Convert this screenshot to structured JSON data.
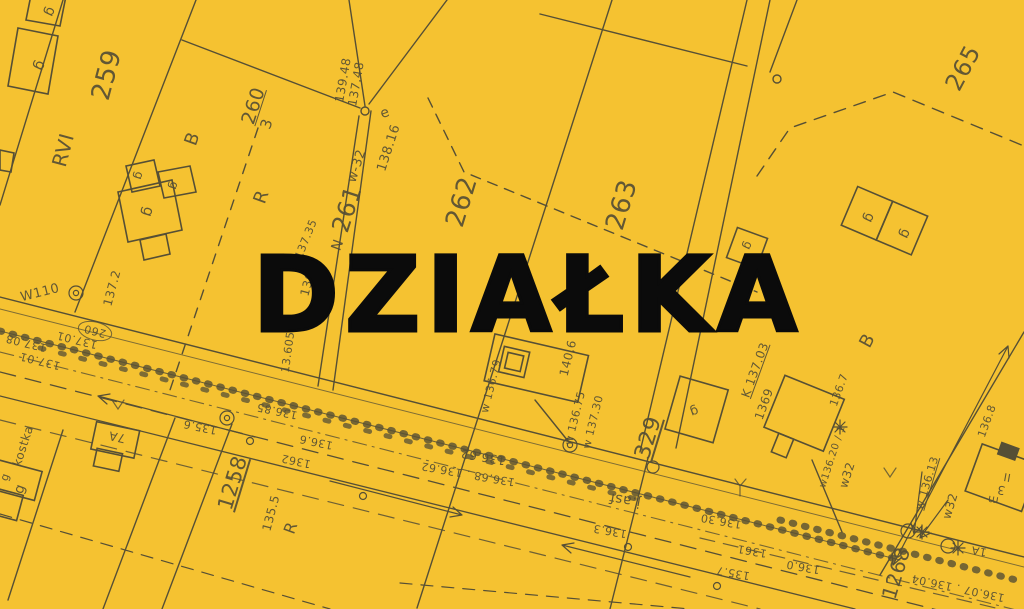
{
  "title": "DZIAŁKA",
  "colors": {
    "background": "#F5C231",
    "line": "#564F35",
    "title": "#0B0B0B"
  },
  "map": {
    "type": "cadastral-plan",
    "labels": [
      {
        "t": "259",
        "x": 107,
        "y": 75,
        "r": -75,
        "s": 26
      },
      {
        "t": "RVI",
        "x": 63,
        "y": 150,
        "r": -75,
        "s": 20
      },
      {
        "t": "260",
        "x": 254,
        "y": 106,
        "r": -72,
        "s": 19,
        "u": 1
      },
      {
        "t": "3",
        "x": 267,
        "y": 124,
        "r": -72,
        "s": 15
      },
      {
        "t": "B",
        "x": 193,
        "y": 139,
        "r": -70,
        "s": 18
      },
      {
        "t": "R",
        "x": 262,
        "y": 197,
        "r": -70,
        "s": 18
      },
      {
        "t": "261",
        "x": 347,
        "y": 209,
        "r": -72,
        "s": 24
      },
      {
        "t": "w-32",
        "x": 357,
        "y": 166,
        "r": -72,
        "s": 13
      },
      {
        "t": "138.16",
        "x": 389,
        "y": 148,
        "r": -72,
        "s": 13
      },
      {
        "t": "139.48",
        "x": 343,
        "y": 80,
        "r": -80,
        "s": 12
      },
      {
        "t": "137.48",
        "x": 356,
        "y": 84,
        "r": -80,
        "s": 12
      },
      {
        "t": "e",
        "x": 385,
        "y": 113,
        "r": -20,
        "s": 14
      },
      {
        "t": "262",
        "x": 462,
        "y": 202,
        "r": -73,
        "s": 26
      },
      {
        "t": "263",
        "x": 622,
        "y": 205,
        "r": -73,
        "s": 26
      },
      {
        "t": "265",
        "x": 963,
        "y": 68,
        "r": -62,
        "s": 24
      },
      {
        "t": "329",
        "x": 649,
        "y": 438,
        "r": -73,
        "s": 22,
        "u": 1
      },
      {
        "t": "1258",
        "x": 233,
        "y": 483,
        "r": -73,
        "s": 21,
        "u": 1
      },
      {
        "t": "1268",
        "x": 896,
        "y": 573,
        "r": -73,
        "s": 20
      },
      {
        "t": "135.5",
        "x": 271,
        "y": 513,
        "r": -75,
        "s": 12
      },
      {
        "t": "R",
        "x": 291,
        "y": 528,
        "r": -70,
        "s": 16
      },
      {
        "t": "N",
        "x": 338,
        "y": 245,
        "r": -70,
        "s": 14
      },
      {
        "t": "137.35",
        "x": 306,
        "y": 239,
        "r": -68,
        "s": 11
      },
      {
        "t": "136.9",
        "x": 309,
        "y": 278,
        "r": -75,
        "s": 12
      },
      {
        "t": "tA",
        "x": 315,
        "y": 317,
        "r": -75,
        "s": 12
      },
      {
        "t": "13.605",
        "x": 288,
        "y": 352,
        "r": -82,
        "s": 11
      },
      {
        "t": "W110",
        "x": 40,
        "y": 293,
        "r": -14,
        "s": 13
      },
      {
        "t": "137.2",
        "x": 112,
        "y": 288,
        "r": -75,
        "s": 12
      },
      {
        "t": "260",
        "x": 95,
        "y": 331,
        "r": 195,
        "s": 11
      },
      {
        "t": "137.08",
        "x": 26,
        "y": 343,
        "r": 194,
        "s": 11
      },
      {
        "t": "137.01",
        "x": 77,
        "y": 340,
        "r": 194,
        "s": 11
      },
      {
        "t": "137.01",
        "x": 40,
        "y": 361,
        "r": 194,
        "s": 11
      },
      {
        "t": "136.85",
        "x": 277,
        "y": 411,
        "r": 192,
        "s": 11
      },
      {
        "t": "135.6",
        "x": 200,
        "y": 427,
        "r": 192,
        "s": 11
      },
      {
        "t": "136.6",
        "x": 316,
        "y": 442,
        "r": 192,
        "s": 11
      },
      {
        "t": "1362",
        "x": 296,
        "y": 461,
        "r": 192,
        "s": 11
      },
      {
        "t": "136.62",
        "x": 483,
        "y": 457,
        "r": 190,
        "s": 12
      },
      {
        "t": "136.68 . 136.62",
        "x": 468,
        "y": 474,
        "r": 190,
        "s": 11
      },
      {
        "t": "j.asf",
        "x": 625,
        "y": 500,
        "r": 190,
        "s": 14
      },
      {
        "t": "136.3",
        "x": 610,
        "y": 531,
        "r": 190,
        "s": 11
      },
      {
        "t": "136.30",
        "x": 721,
        "y": 521,
        "r": 190,
        "s": 11
      },
      {
        "t": "1361",
        "x": 752,
        "y": 551,
        "r": 190,
        "s": 11
      },
      {
        "t": "135.7",
        "x": 733,
        "y": 573,
        "r": 190,
        "s": 11
      },
      {
        "t": "136.0",
        "x": 803,
        "y": 567,
        "r": 190,
        "s": 11
      },
      {
        "t": "1A",
        "x": 979,
        "y": 551,
        "r": 190,
        "s": 11
      },
      {
        "t": "136.07 . 136.04",
        "x": 958,
        "y": 588,
        "r": 192,
        "s": 11
      },
      {
        "t": "w 136.79",
        "x": 491,
        "y": 386,
        "r": -76,
        "s": 11
      },
      {
        "t": "w 136.75",
        "x": 575,
        "y": 418,
        "r": -76,
        "s": 11
      },
      {
        "t": "w 137.30",
        "x": 593,
        "y": 422,
        "r": -76,
        "s": 11
      },
      {
        "t": "140,6",
        "x": 568,
        "y": 358,
        "r": -76,
        "s": 12
      },
      {
        "t": "K 137.03",
        "x": 755,
        "y": 370,
        "r": -70,
        "s": 12,
        "u": 1
      },
      {
        "t": "1369",
        "x": 764,
        "y": 404,
        "r": -70,
        "s": 12
      },
      {
        "t": "136.7",
        "x": 839,
        "y": 390,
        "r": -70,
        "s": 11
      },
      {
        "t": "B",
        "x": 868,
        "y": 341,
        "r": -62,
        "s": 18
      },
      {
        "t": "w136.20 / 1",
        "x": 833,
        "y": 457,
        "r": -72,
        "s": 10
      },
      {
        "t": "w32",
        "x": 847,
        "y": 475,
        "r": -72,
        "s": 12
      },
      {
        "t": "136.8",
        "x": 987,
        "y": 421,
        "r": -70,
        "s": 11
      },
      {
        "t": "w 136.13",
        "x": 927,
        "y": 483,
        "r": -73,
        "s": 11,
        "u": 1
      },
      {
        "t": "w32",
        "x": 950,
        "y": 506,
        "r": -73,
        "s": 12
      },
      {
        "t": "m",
        "x": 993,
        "y": 500,
        "r": 190,
        "s": 11
      },
      {
        "t": "3",
        "x": 1001,
        "y": 490,
        "r": 190,
        "s": 12
      },
      {
        "t": "II",
        "x": 1007,
        "y": 477,
        "r": 190,
        "s": 11
      },
      {
        "t": "7A",
        "x": 117,
        "y": 437,
        "r": 192,
        "s": 12
      },
      {
        "t": "kostka",
        "x": 23,
        "y": 446,
        "r": -72,
        "s": 12
      },
      {
        "t": "g",
        "x": 50,
        "y": 12,
        "r": 115,
        "s": 14
      },
      {
        "t": "g",
        "x": 40,
        "y": 66,
        "r": 115,
        "s": 15
      },
      {
        "t": "g",
        "x": 139,
        "y": 176,
        "r": 108,
        "s": 12
      },
      {
        "t": "g",
        "x": 174,
        "y": 186,
        "r": 108,
        "s": 12
      },
      {
        "t": "g",
        "x": 148,
        "y": 212,
        "r": 108,
        "s": 15
      },
      {
        "t": "g",
        "x": 869,
        "y": 218,
        "r": 115,
        "s": 14
      },
      {
        "t": "g",
        "x": 905,
        "y": 234,
        "r": 115,
        "s": 14
      },
      {
        "t": "g",
        "x": 748,
        "y": 246,
        "r": 115,
        "s": 12
      },
      {
        "t": "g",
        "x": 694,
        "y": 411,
        "r": 160,
        "s": 13
      },
      {
        "t": "g",
        "x": 20,
        "y": 489,
        "r": -70,
        "s": 14
      },
      {
        "t": "g",
        "x": 5,
        "y": 477,
        "r": -70,
        "s": 11
      }
    ]
  }
}
